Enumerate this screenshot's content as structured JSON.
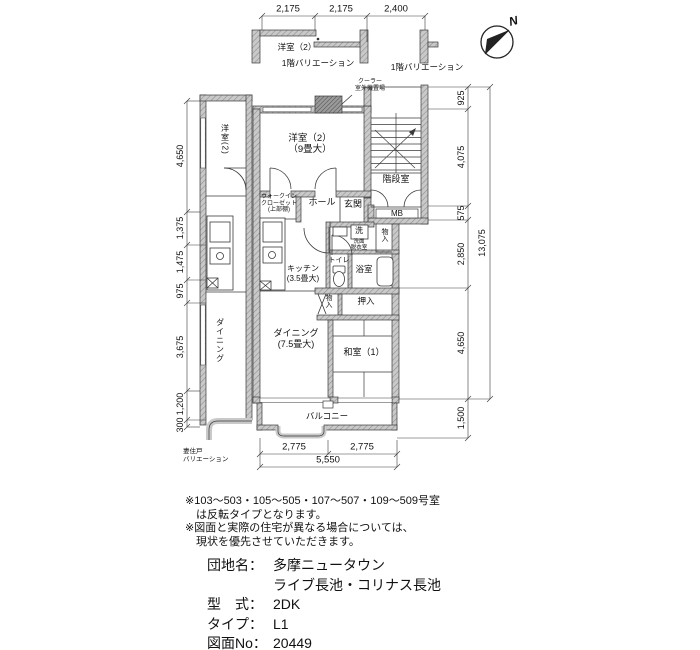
{
  "compass": {
    "north_label": "N"
  },
  "variations": {
    "top": {
      "room": "洋室（2）",
      "label": "1階バリエーション"
    },
    "top_right_label": "1階バリエーション",
    "left_strip": {
      "room": "洋室(2)",
      "dining": "ダイニング"
    },
    "end_unit": {
      "line1": "妻住戸",
      "line2": "バリエーション"
    }
  },
  "rooms": {
    "cooler": {
      "line1": "クーラー",
      "line2": "室外機置場"
    },
    "western_main": {
      "line1": "洋室（2）",
      "line2": "（9畳大）"
    },
    "stairwell": "階段室",
    "hall": "ホール",
    "entrance": "玄関",
    "meter_box": "MB",
    "walkin_closet": {
      "line1": "ウォークイン",
      "line2": "クローゼット",
      "line3": "(上部棚)"
    },
    "washer": "洗",
    "washroom": {
      "line1": "洗面",
      "line2": "脱衣室"
    },
    "toilet": "トイレ",
    "bath": "浴室",
    "storage_upper": "物入",
    "kitchen": {
      "line1": "キッチン",
      "line2": "(3.5畳大)"
    },
    "storage_lower": "物入",
    "oshiire": "押入",
    "dining": {
      "line1": "ダイニング",
      "line2": "(7.5畳大)"
    },
    "japanese_room": "和室（1）",
    "balcony": "バルコニー"
  },
  "dimensions": {
    "top": [
      "2,175",
      "2,175",
      "2,400"
    ],
    "left": [
      "4,650",
      "1,375",
      "1,475",
      "975",
      "3,675",
      "1,200",
      "300"
    ],
    "right": [
      "925",
      "4,075",
      "575",
      "2,850",
      "4,650",
      "1,500"
    ],
    "right_total": "13,075",
    "bottom": [
      "2,775",
      "2,775"
    ],
    "bottom_total": "5,550"
  },
  "notes": {
    "line1": "※103～503・105～505・107～507・109～509号室",
    "line2": "は反転タイプとなります。",
    "line3": "※図面と実際の住宅が異なる場合については、",
    "line4": "現状を優先させていただきます。"
  },
  "info": {
    "rows": [
      {
        "label": "団地名：",
        "value": "多摩ニュータウン"
      },
      {
        "label": "",
        "value": "ライブ長池・コリナス長池"
      },
      {
        "label": "型　式：",
        "value": "2DK"
      },
      {
        "label": "タイプ：",
        "value": "L1"
      },
      {
        "label": "図面No：",
        "value": "20449"
      }
    ]
  }
}
